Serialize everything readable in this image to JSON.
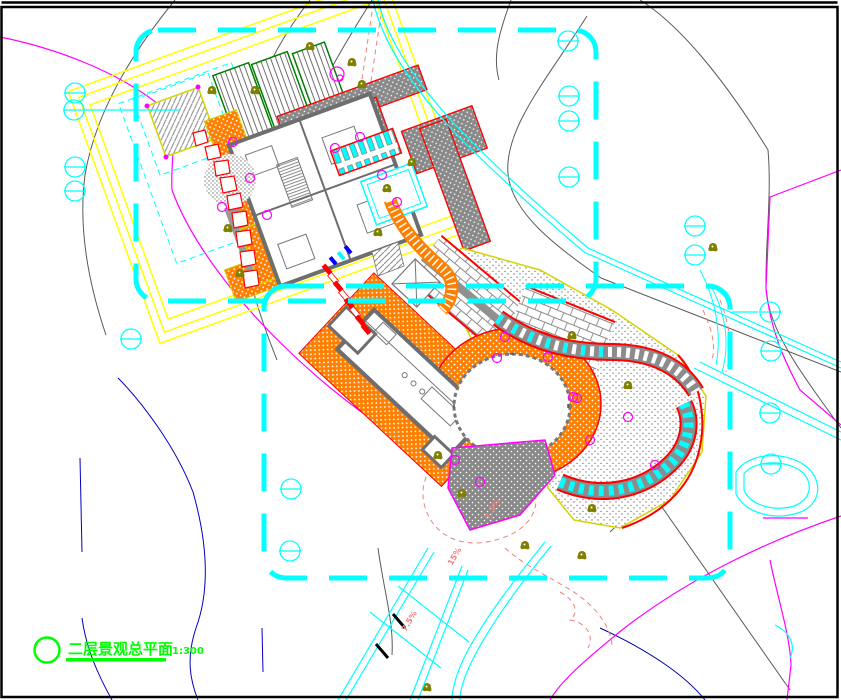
{
  "drawing": {
    "title": "二层景观总平面",
    "scale_label": "1:300",
    "slope_labels": [
      "7.5%",
      "15%",
      "7.5%"
    ],
    "symbols": {
      "survey_marker": "circle-with-horizontal-line",
      "survey_marker_count": 17,
      "legend_marker": "empty-circle"
    },
    "colors": {
      "boundary_cyan": "#00FFFF",
      "paving_orange": "#FF7F00",
      "road_yellow": "#FFFF00",
      "accent_red": "#FF0000",
      "title_green": "#00FF00",
      "bed_border_green": "#007F00",
      "tree_olive": "#7F7F00",
      "plant_magenta": "#FF00FF",
      "contour_grey": "#5A5A5A",
      "contour_blue": "#0000C8",
      "contour_salmon": "#F08080",
      "wall_grey": "#6E6E6E",
      "background": "#FFFFFF",
      "frame_black": "#000000"
    }
  }
}
